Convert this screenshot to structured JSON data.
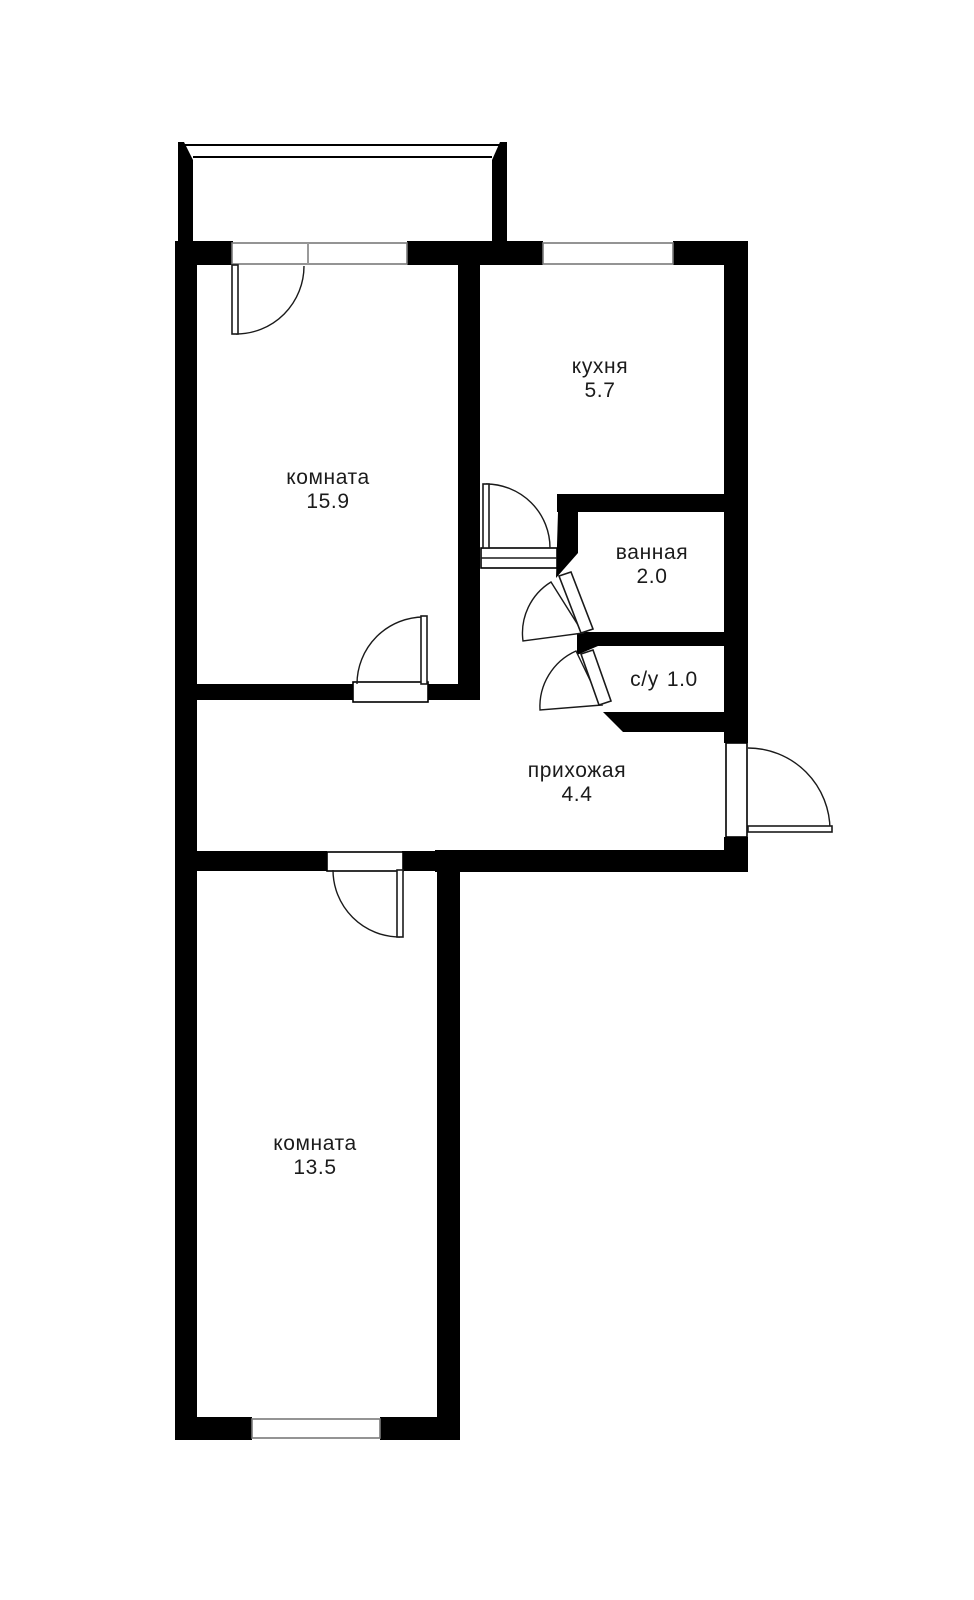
{
  "floorplan": {
    "background_color": "#ffffff",
    "wall_color": "#000000",
    "window_frame_color": "#7a7a7a",
    "text_color": "#1b1b1b",
    "rooms": [
      {
        "id": "room-1",
        "name": "комната",
        "area": "15.9"
      },
      {
        "id": "kitchen",
        "name": "кухня",
        "area": "5.7"
      },
      {
        "id": "bathroom",
        "name": "ванная",
        "area": "2.0"
      },
      {
        "id": "wc",
        "name": "с/у",
        "area": "1.0"
      },
      {
        "id": "hallway",
        "name": "прихожая",
        "area": "4.4"
      },
      {
        "id": "room-2",
        "name": "комната",
        "area": "13.5"
      }
    ],
    "features": {
      "balcony": "балкон",
      "doors": 7,
      "windows": 3
    }
  }
}
